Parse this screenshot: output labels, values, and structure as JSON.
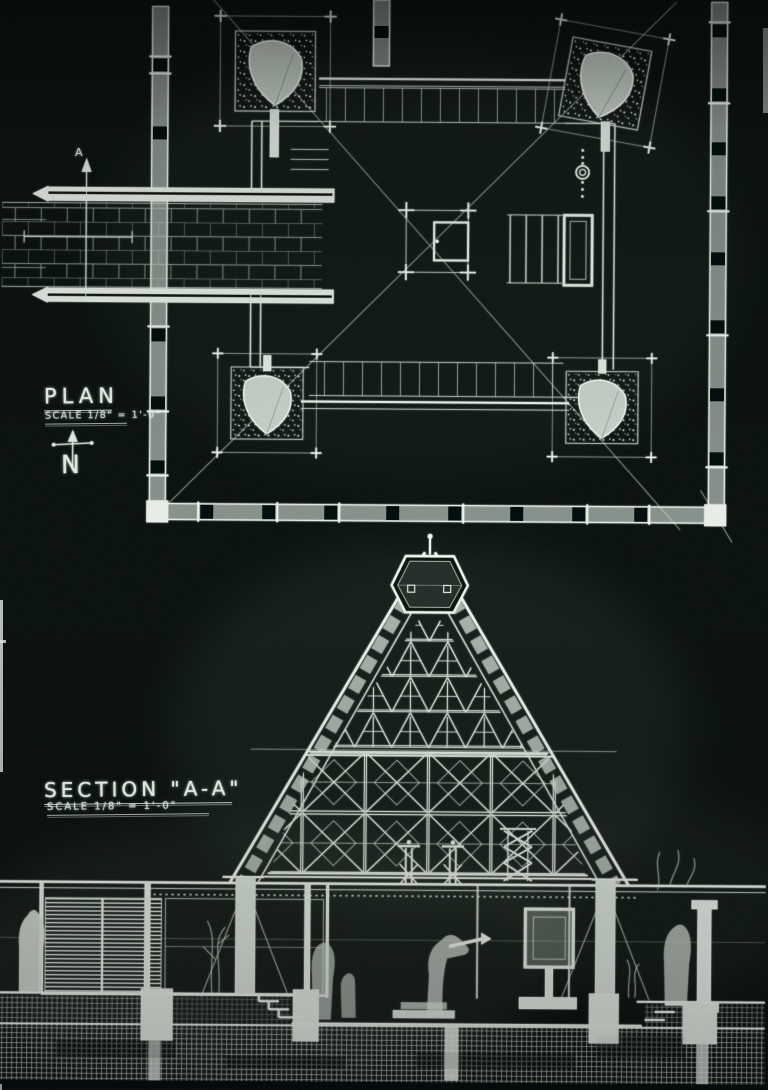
{
  "photo": {
    "background": "#0a110e",
    "deep_black": "#060c09",
    "ink_bright": "#eef5ee",
    "ink": "#dde7de",
    "ink_dim": "#9fb0a5"
  },
  "plan": {
    "title": "PLAN",
    "scale": "SCALE 1/8\" = 1'-0\"",
    "north": "N",
    "cut_marker": "A"
  },
  "section": {
    "title": "SECTION \"A-A\"",
    "scale": "SCALE 1/8\" = 1'-0\""
  }
}
